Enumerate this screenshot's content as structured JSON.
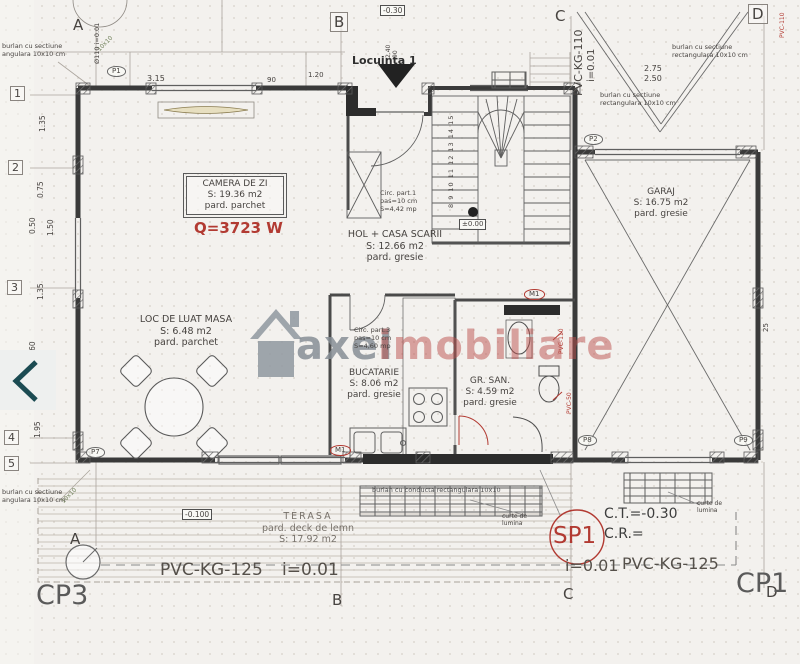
{
  "carousel": {
    "prev_icon": "chevron-left"
  },
  "watermark": {
    "brand_gray": "axel",
    "brand_red": "imobiliare"
  },
  "grid": {
    "top": [
      "A",
      "B",
      "C",
      "D"
    ],
    "bottom": [
      "A",
      "B",
      "C",
      "D"
    ],
    "left": [
      "1",
      "2",
      "3",
      "4",
      "5"
    ]
  },
  "rooms": [
    {
      "name": "CAMERA DE ZI",
      "area": "S: 19.36 m2",
      "floor": "pard. parchet"
    },
    {
      "name": "LOC DE LUAT MASA",
      "area": "S: 6.48 m2",
      "floor": "pard. parchet"
    },
    {
      "name": "HOL + CASA SCARII",
      "area": "S: 12.66 m2",
      "floor": "pard. gresie"
    },
    {
      "name": "BUCATARIE",
      "area": "S: 8.06 m2",
      "floor": "pard. gresie"
    },
    {
      "name": "GR. SAN.",
      "area": "S: 4.59 m2",
      "floor": "pard. gresie"
    },
    {
      "name": "GARAJ",
      "area": "S: 16.75 m2",
      "floor": "pard. gresie"
    },
    {
      "name": "TERASA",
      "area": "S: 17.92 m2",
      "floor": "pard. deck de lemn"
    }
  ],
  "annotations": {
    "heat_load": "Q=3723 W",
    "unit": "Locuinta 1",
    "level_zero": "±0.00",
    "level_entry": "-0.30",
    "level_terrace": "-0.100",
    "stair_note": {
      "l1": "Circ. part.1",
      "l2": "pas=10 cm",
      "l3": "S=4,42 mp"
    },
    "hall_note": {
      "l1": "Circ. part.3",
      "l2": "pas=10 cm",
      "l3": "S=4,60 mp"
    },
    "downspout_l1": "burlan cu sectiune",
    "downspout_l2": "rectangulara 10x10 cm",
    "downspout_l2_cut": "angulara 10x10 cm",
    "grate_note": "burlan cu conducta rectangulara 10x10",
    "light_court_l1": "curte de",
    "light_court_l2": "lumina",
    "step_numbers": "8 9 10 11 12 13 14 15",
    "column_stamp": "10x10"
  },
  "pipes": {
    "roof_drain": "PVC-KG-110",
    "roof_drain_slope": "i=0.01",
    "sewer_left": "PVC-KG-125",
    "sewer_left_slope": "i=0.01",
    "sewer_right_slope": "i=0.01",
    "sewer_right": "PVC-KG-125",
    "downpipe": "Ø110 i=0.01",
    "bath_pipe_a": "PVC-110",
    "bath_pipe_b": "PVC-50",
    "corner_pipe": "PVC-110"
  },
  "site": {
    "cp3": "CP3",
    "cp1": "CP1",
    "sp1": "SP1",
    "ct": "C.T.=-0.30",
    "cr": "C.R.="
  },
  "markers": {
    "p1": "P1",
    "p2": "P2",
    "p7": "P7",
    "p8": "P8",
    "p9": "P9",
    "m1": "M1"
  },
  "dims": {
    "top_1": "3.15",
    "top_2": "90",
    "top_3": "1.20",
    "left_1": "1.35",
    "left_2": "0.75",
    "left_3": "0.50",
    "left_4": "1.50",
    "left_5": "1.35",
    "left_6": "0.60",
    "left_7": "1.95",
    "garage_1": "2.75",
    "garage_2": "2.50",
    "door_1": "2.40",
    "door_2": "90",
    "right_1": "25"
  }
}
